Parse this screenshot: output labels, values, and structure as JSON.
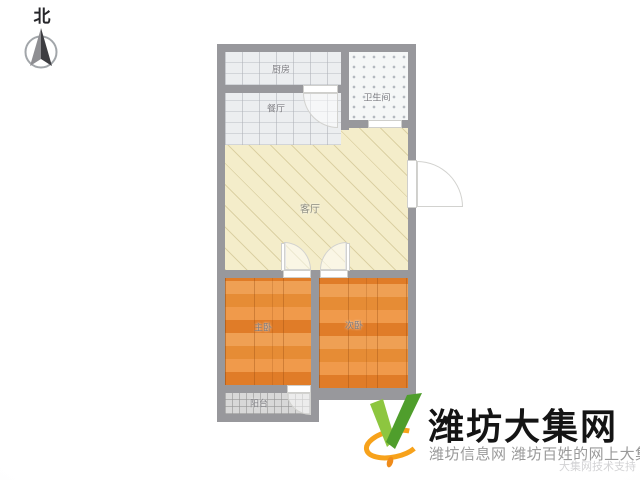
{
  "compass": {
    "label": "北",
    "icon": "north-compass-icon"
  },
  "floorplan": {
    "rooms": [
      {
        "id": "kitchen",
        "label": "厨房"
      },
      {
        "id": "dining",
        "label": "餐厅"
      },
      {
        "id": "bathroom",
        "label": "卫生间"
      },
      {
        "id": "living",
        "label": "客厅"
      },
      {
        "id": "master-bedroom",
        "label": "主卧"
      },
      {
        "id": "second-bedroom",
        "label": "次卧"
      },
      {
        "id": "balcony",
        "label": "阳台"
      }
    ],
    "colors": {
      "wall": "#98989c",
      "living_floor": "#f4edca",
      "bedroom_floor": "#e8883a",
      "kitchen_floor": "#eceef0",
      "bathroom_floor": "#f5f7f7",
      "balcony_floor": "#d8d8d8"
    }
  },
  "logo": {
    "icon": "v-check-logo-icon",
    "site_name": "潍坊大集网",
    "tagline": "潍坊信息网 潍坊百姓的网上大集",
    "watermark": "大集网技术支持",
    "colors": {
      "green_light": "#8dc63f",
      "green_dark": "#4f9e2c",
      "orange": "#f7a21b",
      "title": "#141414",
      "tagline": "#9a9a9a"
    }
  }
}
